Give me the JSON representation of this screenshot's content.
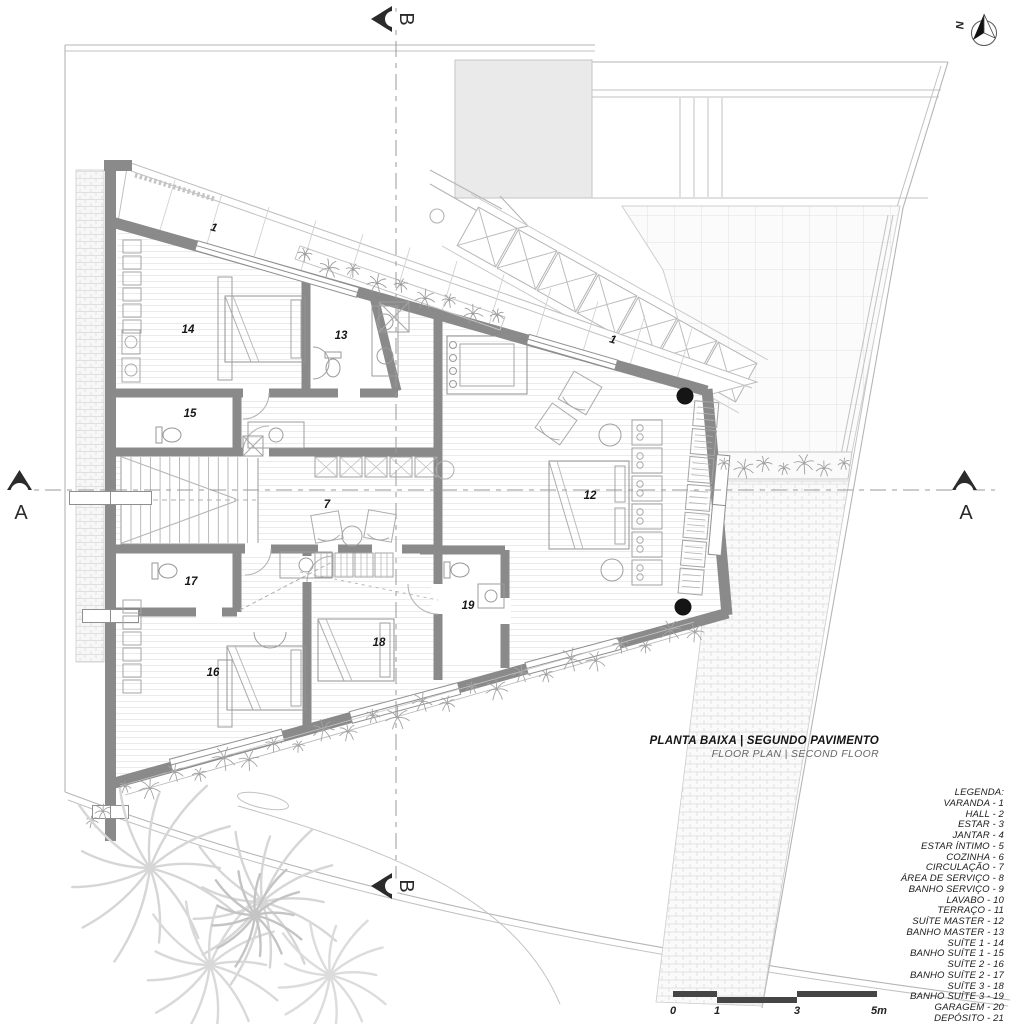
{
  "drawing": {
    "title_primary": "PLANTA BAIXA | SEGUNDO PAVIMENTO",
    "title_secondary": "FLOOR PLAN | SECOND FLOOR",
    "north_label": "N"
  },
  "sections": {
    "a_label": "A",
    "b_label": "B"
  },
  "scalebar": {
    "labels": [
      "0",
      "1",
      "3",
      "5m"
    ]
  },
  "legend": {
    "header": "LEGENDA:",
    "items": [
      "VARANDA - 1",
      "HALL - 2",
      "ESTAR - 3",
      "JANTAR - 4",
      "ESTAR ÍNTIMO - 5",
      "COZINHA - 6",
      "CIRCULAÇÃO - 7",
      "ÁREA DE SERVIÇO - 8",
      "BANHO SERVIÇO - 9",
      "LAVABO - 10",
      "TERRAÇO - 11",
      "SUÍTE MASTER - 12",
      "BANHO MASTER - 13",
      "SUÍTE 1 - 14",
      "BANHO SUÍTE 1 - 15",
      "SUÍTE 2 - 16",
      "BANHO SUÍTE 2 - 17",
      "SUÍTE 3 - 18",
      "BANHO SUÍTE 3 - 19",
      "GARAGEM - 20",
      "DEPÓSITO - 21"
    ]
  },
  "rooms": [
    {
      "number": "1",
      "name": "VARANDA",
      "x": 213,
      "y": 231,
      "rotate": 16
    },
    {
      "number": "1",
      "name": "VARANDA",
      "x": 612,
      "y": 343,
      "rotate": 16
    },
    {
      "number": "14",
      "name": "SUÍTE 1",
      "x": 188,
      "y": 333
    },
    {
      "number": "13",
      "name": "BANHO MASTER",
      "x": 341,
      "y": 339
    },
    {
      "number": "15",
      "name": "BANHO SUÍTE 1",
      "x": 190,
      "y": 417
    },
    {
      "number": "7",
      "name": "CIRCULAÇÃO",
      "x": 327,
      "y": 508
    },
    {
      "number": "12",
      "name": "SUÍTE MASTER",
      "x": 590,
      "y": 499
    },
    {
      "number": "17",
      "name": "BANHO SUÍTE 2",
      "x": 191,
      "y": 585
    },
    {
      "number": "19",
      "name": "BANHO SUÍTE 3",
      "x": 468,
      "y": 609
    },
    {
      "number": "18",
      "name": "SUÍTE 3",
      "x": 379,
      "y": 646
    },
    {
      "number": "16",
      "name": "SUÍTE 2",
      "x": 213,
      "y": 676
    }
  ],
  "colors": {
    "wall": "#8a8a8a",
    "column": "#151515",
    "scale_bar": "#454545",
    "title_text": "#141414",
    "secondary_text": "#666666",
    "line_light": "#c6c6c6"
  }
}
